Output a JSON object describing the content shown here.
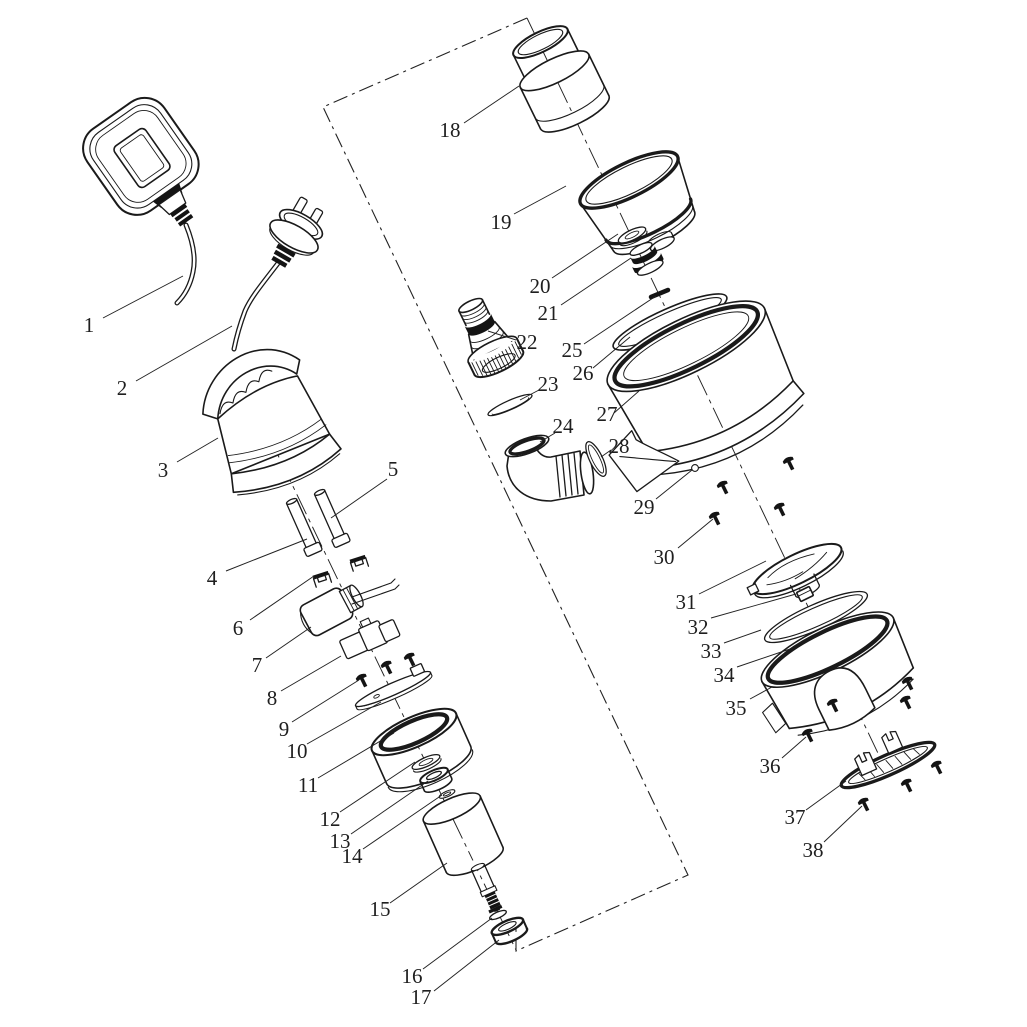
{
  "figure": {
    "background": "#ffffff",
    "ink": "#1a1a1a",
    "label_color": "#1f1f1f",
    "label_font_size": 21
  },
  "boundary": {
    "points": "527,18 323,107 688,875 516,951 516,926"
  },
  "axes": [
    {
      "x1": 250,
      "y1": 397,
      "x2": 516,
      "y2": 950
    },
    {
      "x1": 527,
      "y1": 18,
      "x2": 886,
      "y2": 770
    }
  ],
  "callouts": [
    {
      "n": "1",
      "x": 89,
      "y": 325,
      "l": [
        103,
        318,
        183,
        276
      ]
    },
    {
      "n": "2",
      "x": 122,
      "y": 388,
      "l": [
        136,
        381,
        232,
        326
      ]
    },
    {
      "n": "3",
      "x": 163,
      "y": 470,
      "l": [
        177,
        462,
        218,
        438
      ]
    },
    {
      "n": "4",
      "x": 212,
      "y": 578,
      "l": [
        226,
        571,
        307,
        539
      ]
    },
    {
      "n": "5",
      "x": 393,
      "y": 469,
      "l": [
        387,
        479,
        331,
        518
      ]
    },
    {
      "n": "6",
      "x": 238,
      "y": 628,
      "l": [
        250,
        620,
        314,
        576
      ]
    },
    {
      "n": "7",
      "x": 257,
      "y": 665,
      "l": [
        266,
        658,
        311,
        627
      ]
    },
    {
      "n": "8",
      "x": 272,
      "y": 698,
      "l": [
        281,
        691,
        341,
        656
      ]
    },
    {
      "n": "9",
      "x": 284,
      "y": 729,
      "l": [
        292,
        722,
        359,
        680
      ]
    },
    {
      "n": "10",
      "x": 297,
      "y": 751,
      "l": [
        307,
        744,
        381,
        702
      ]
    },
    {
      "n": "11",
      "x": 308,
      "y": 785,
      "l": [
        318,
        778,
        394,
        733
      ]
    },
    {
      "n": "12",
      "x": 330,
      "y": 819,
      "l": [
        340,
        812,
        415,
        762
      ]
    },
    {
      "n": "13",
      "x": 340,
      "y": 841,
      "l": [
        351,
        834,
        428,
        781
      ]
    },
    {
      "n": "14",
      "x": 352,
      "y": 856,
      "l": [
        363,
        849,
        442,
        795
      ]
    },
    {
      "n": "15",
      "x": 380,
      "y": 909,
      "l": [
        390,
        903,
        447,
        863
      ]
    },
    {
      "n": "16",
      "x": 412,
      "y": 976,
      "l": [
        423,
        969,
        492,
        918
      ]
    },
    {
      "n": "17",
      "x": 421,
      "y": 997,
      "l": [
        434,
        991,
        499,
        940
      ]
    },
    {
      "n": "18",
      "x": 450,
      "y": 130,
      "l": [
        464,
        123,
        519,
        86
      ]
    },
    {
      "n": "19",
      "x": 501,
      "y": 222,
      "l": [
        514,
        214,
        566,
        186
      ]
    },
    {
      "n": "20",
      "x": 540,
      "y": 286,
      "l": [
        552,
        278,
        618,
        234
      ]
    },
    {
      "n": "21",
      "x": 548,
      "y": 313,
      "l": [
        561,
        305,
        631,
        258
      ]
    },
    {
      "n": "22",
      "x": 527,
      "y": 342,
      "l": [
        516,
        340,
        488,
        331
      ]
    },
    {
      "n": "23",
      "x": 548,
      "y": 384,
      "l": [
        539,
        390,
        520,
        400
      ]
    },
    {
      "n": "24",
      "x": 563,
      "y": 426,
      "l": [
        555,
        433,
        540,
        442
      ]
    },
    {
      "n": "25",
      "x": 572,
      "y": 350,
      "l": [
        584,
        344,
        656,
        296
      ]
    },
    {
      "n": "26",
      "x": 583,
      "y": 373,
      "l": [
        593,
        368,
        630,
        337
      ]
    },
    {
      "n": "27",
      "x": 607,
      "y": 414,
      "l": [
        614,
        413,
        639,
        391
      ]
    },
    {
      "n": "28",
      "x": 619,
      "y": 446,
      "l": [
        611,
        450,
        601,
        457
      ]
    },
    {
      "n": "29",
      "x": 644,
      "y": 507,
      "l": [
        656,
        499,
        692,
        470
      ]
    },
    {
      "n": "30",
      "x": 664,
      "y": 557,
      "l": [
        678,
        548,
        713,
        519
      ]
    },
    {
      "n": "31",
      "x": 686,
      "y": 602,
      "l": [
        699,
        594,
        766,
        561
      ]
    },
    {
      "n": "32",
      "x": 698,
      "y": 627,
      "l": [
        711,
        618,
        796,
        594
      ]
    },
    {
      "n": "33",
      "x": 711,
      "y": 651,
      "l": [
        724,
        643,
        761,
        630
      ]
    },
    {
      "n": "34",
      "x": 724,
      "y": 675,
      "l": [
        737,
        667,
        790,
        649
      ]
    },
    {
      "n": "35",
      "x": 736,
      "y": 708,
      "l": [
        750,
        699,
        772,
        687
      ]
    },
    {
      "n": "36",
      "x": 770,
      "y": 766,
      "l": [
        782,
        758,
        806,
        737
      ]
    },
    {
      "n": "37",
      "x": 795,
      "y": 817,
      "l": [
        806,
        810,
        846,
        781
      ]
    },
    {
      "n": "38",
      "x": 813,
      "y": 850,
      "l": [
        824,
        842,
        862,
        806
      ]
    }
  ]
}
